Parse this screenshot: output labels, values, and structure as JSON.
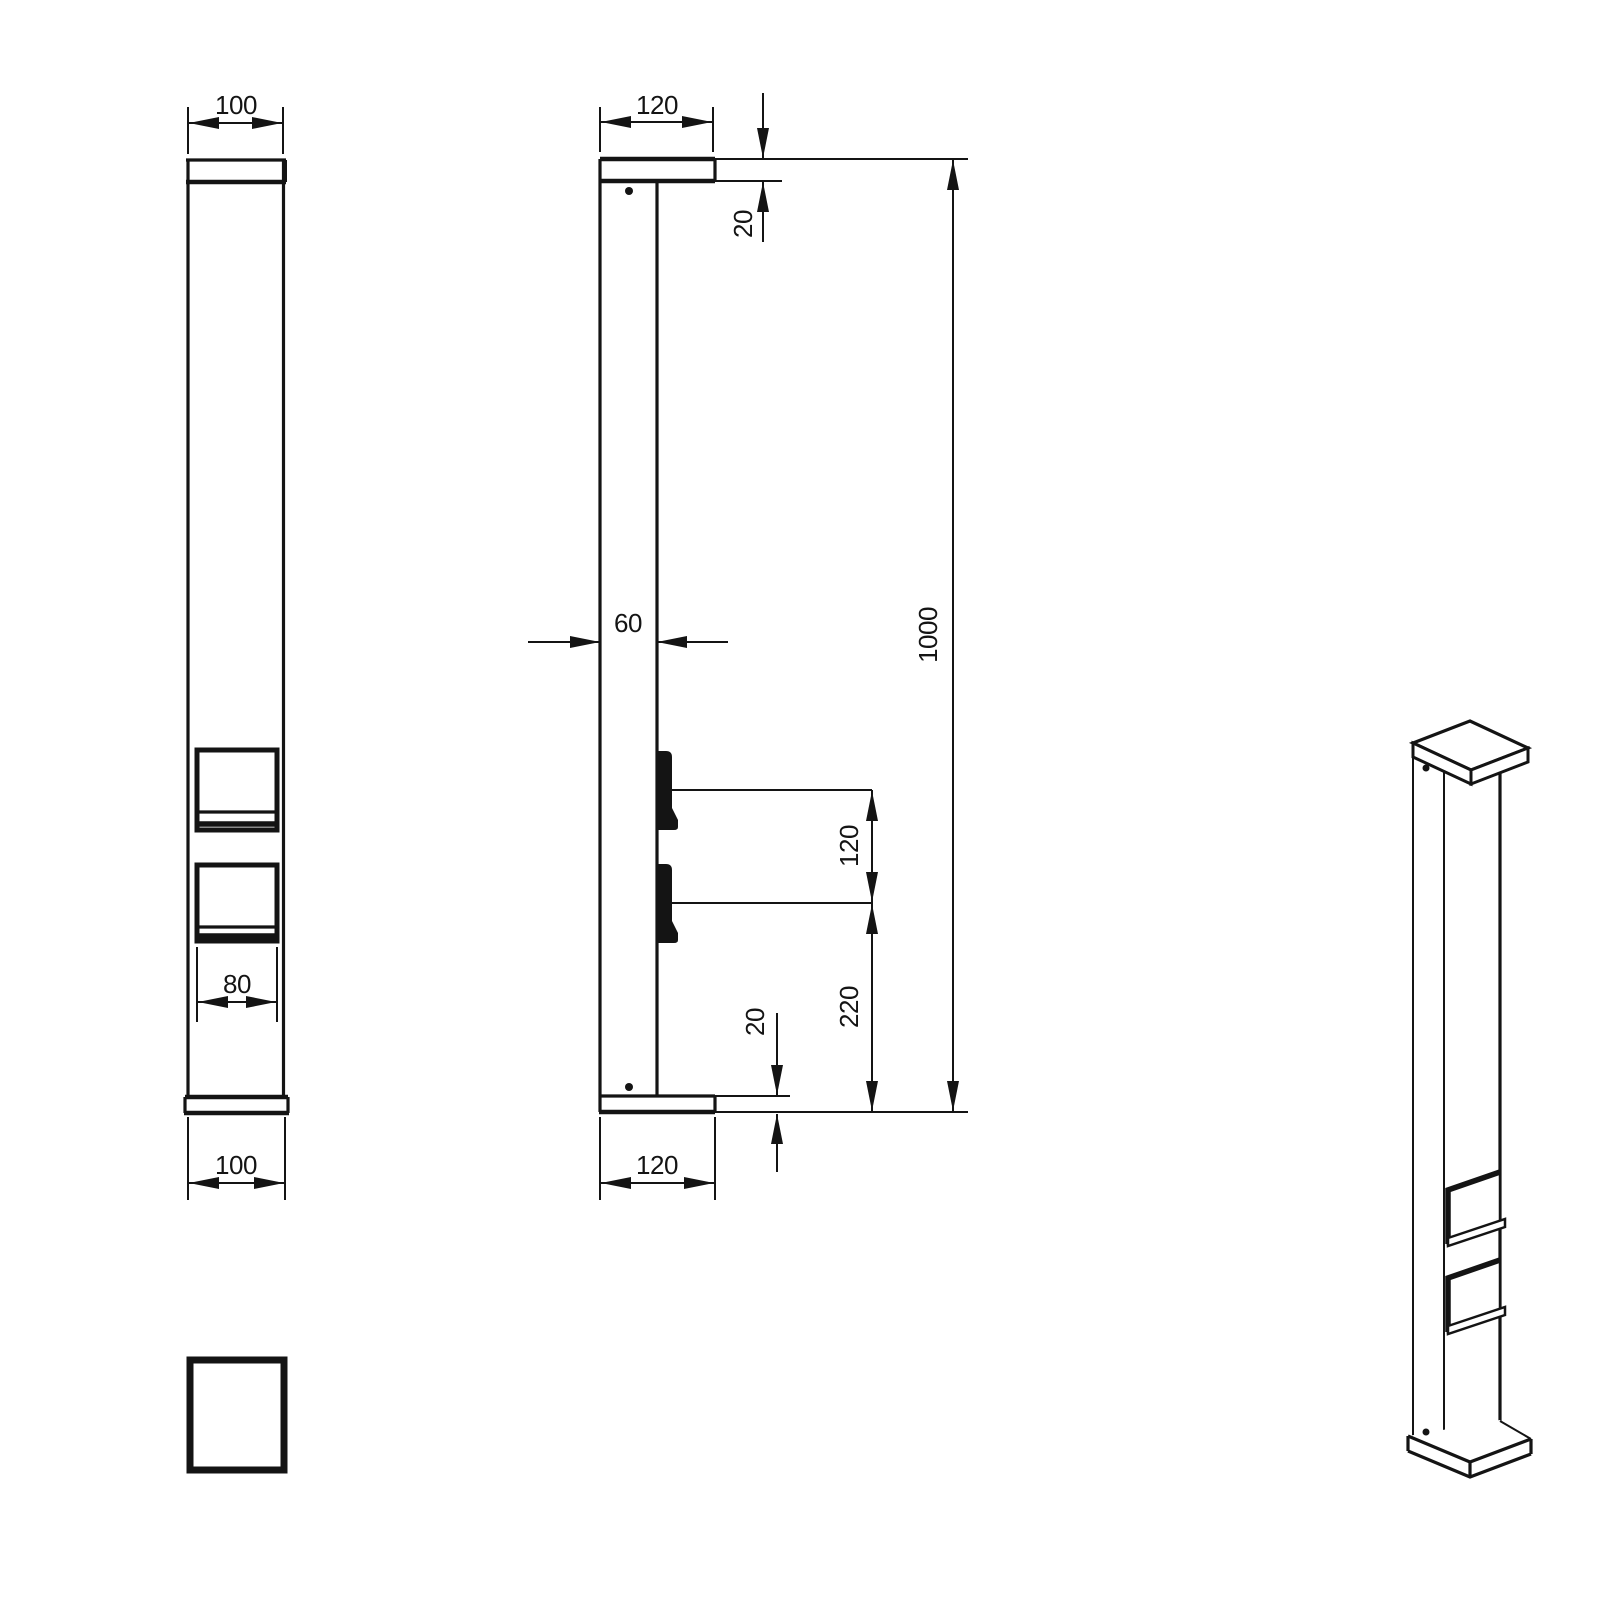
{
  "drawing": {
    "type": "technical-drawing",
    "line_color": "#141414",
    "background_color": "#ffffff",
    "dims": {
      "front_top_width": "100",
      "front_socket_width": "80",
      "front_bottom_width": "100",
      "side_cap_depth": "120",
      "side_cap_thickness": "20",
      "side_post_depth": "60",
      "side_socket_spacing": "120",
      "side_socket_base_offset": "220",
      "side_base_thickness": "20",
      "side_base_depth": "120",
      "side_total_height": "1000"
    }
  }
}
